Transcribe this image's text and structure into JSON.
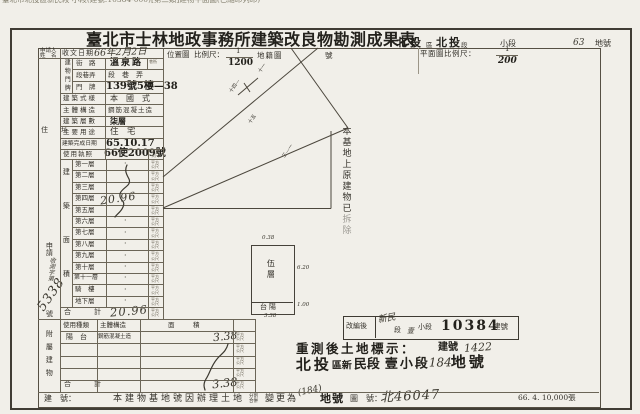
{
  "colors": {
    "ink": "#34312a",
    "stamp": "#23211c",
    "line": "#6b6557",
    "paper": "#f1efe9"
  },
  "scan": {
    "top_cutoff_text": "臺北市北投區新民段 小段(建號:10384-000)[第二類]建物平面圖(已縮印列印)",
    "print_batch": "66. 4. 10,000張"
  },
  "header": {
    "title": "臺北市士林地政事務所建築改良物勘測成果表",
    "district": "北投",
    "district_unit": "區",
    "section": "北投",
    "section_unit": "段",
    "subsection_label": "小段",
    "lot_no": "63",
    "lot_unit": "地號"
  },
  "scale_row": {
    "applicant_line1": "申請人",
    "applicant_line2": "姓　名",
    "receive_label": "收文日期",
    "receive_value": "66年2月2日",
    "location_label": "位置圖",
    "scale_label": "比例尺：",
    "location_num": "1",
    "location_den": "1200",
    "cadastral_label": "地籍圖",
    "number_label": "號",
    "plan_scale_label": "平面圖比例尺：",
    "plan_num": "1",
    "plan_den": "200"
  },
  "building": {
    "door_group": "建物門牌",
    "street_label": "街　路",
    "street_value": "溫泉路",
    "street_extra": "巷衖",
    "seg_label": "段巷弄",
    "seg_value": "段　巷　弄",
    "door_label": "門　牌",
    "door_value": "139號5樓—38",
    "style_label": "建築式樣",
    "style_value": "本　國　式",
    "structure_label": "主體構造",
    "structure_value": "鋼筋混凝土造",
    "floors_label": "建築層數",
    "floors_value": "柒層",
    "use_label": "主要用途",
    "use_value": "住　宅",
    "complete_label": "建築完成日期",
    "complete_value": "65.10.17",
    "license_label": "使用執照",
    "license_value": "66使2009號"
  },
  "area_table": {
    "group_label": "建築面積",
    "floors": [
      {
        "label": "第一層",
        "value": ""
      },
      {
        "label": "第二層",
        "value": ""
      },
      {
        "label": "第三層",
        "value": ""
      },
      {
        "label": "第四層",
        "value": ""
      },
      {
        "label": "第五層",
        "value": "20.96"
      },
      {
        "label": "第六層",
        "value": ""
      },
      {
        "label": "第七層",
        "value": ""
      },
      {
        "label": "第八層",
        "value": ""
      },
      {
        "label": "第九層",
        "value": ""
      },
      {
        "label": "第十層",
        "value": ""
      },
      {
        "label": "第十一層",
        "value": ""
      },
      {
        "label": "騎　樓",
        "value": ""
      },
      {
        "label": "地下層",
        "value": ""
      }
    ],
    "total_label": "合　計",
    "total_value": "20.96"
  },
  "unit": "平方公尺",
  "attached": {
    "group_label": "附屬建物",
    "col_use": "使用種類",
    "col_structure": "主體構造",
    "col_area": "面　積",
    "row_use": "陽　台",
    "row_structure": "鋼筋混凝土造",
    "row_area": "3.38",
    "total_label": "合　計",
    "total_value": "3.38"
  },
  "margin": {
    "address_label": "住　址",
    "apply_label": "申請",
    "apply_script": "收測字第",
    "apply_no": "5338",
    "no_suffix": "號"
  },
  "map": {
    "note_vertical_a": "本基地上原建物已",
    "note_vertical_b": "拆除",
    "lot_marks": [
      "十一",
      "十四—",
      "十五",
      "三—一"
    ],
    "plan_floor": "伍層",
    "plan_balcony": "台陽",
    "dim_top": "0.38",
    "dim_right": "6.20",
    "dim_balcony": "1.00",
    "dim_bottom": "3.38"
  },
  "stamps": {
    "reorg_label": "改編後",
    "reorg_sec_hand": "新民",
    "reorg_sec": "段",
    "reorg_sub_hand": "壹",
    "reorg_sub": "小段",
    "reorg_no": "10384",
    "reorg_no_unit": "建號",
    "resurvey_title": "重測後土地標示：",
    "resurvey_bldg_label": "建號",
    "resurvey_bldg_no": "1422",
    "loc_a": "北投",
    "loc_b": "區新",
    "loc_c": "民段",
    "loc_d": "壹小段",
    "loc_no": "184",
    "loc_unit": "地號"
  },
  "footer": {
    "note_label": "建　號：",
    "note_main": "本建物基地號因辦理土地",
    "note_small_a": "分割",
    "note_small_b": "合併",
    "note_mid": "變更為",
    "note_hand": "(184)",
    "note_tail": "地號",
    "mapno_label": "圖　號：",
    "mapno_value": "北46047"
  }
}
